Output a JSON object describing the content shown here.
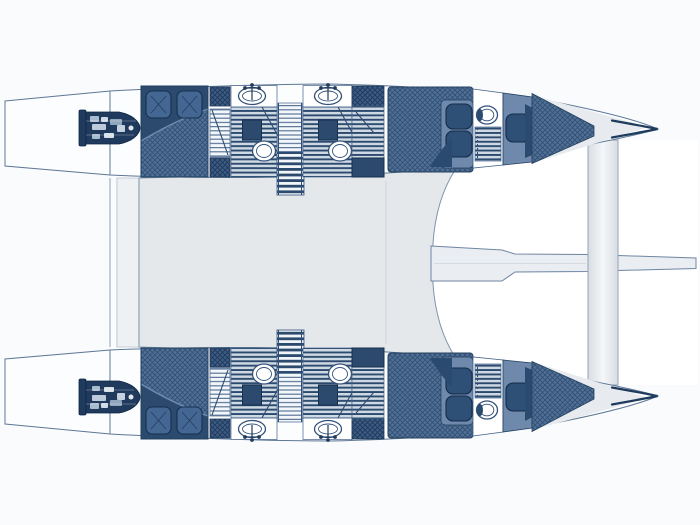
{
  "diagram": {
    "type": "floor-plan",
    "subject": "catamaran deck layout, top view",
    "orientation": "bow pointing right, twin hulls top and bottom",
    "features": {
      "hulls": 2,
      "engines": 2,
      "aft_double_cabins": 2,
      "forward_berths_per_hull": 2,
      "bathrooms_with_shower": 4,
      "bow_toilet_compartments": 2,
      "sinks": 4,
      "toilets": 6,
      "shower_seats": 4,
      "staircases_per_hull": 2,
      "bridgedeck_saloon": 1,
      "aft_cockpit_strip": 1,
      "forward_crossbeam": 1,
      "bowsprit": 1,
      "trampoline_area": 1
    }
  },
  "colors": {
    "page_background": "#fafbfc",
    "trampoline_white": "#ffffff",
    "bridgedeck_gray": "#e4e8eb",
    "cockpit_gray": "#eef1f4",
    "deck": "#e7eaee",
    "hull_white": "#fcfdff",
    "outline": "#5d7795",
    "navy": "#2b4a6e",
    "navy_dark": "#1f3a5c",
    "slate": "#4f7097",
    "slate_dark": "#3c5c84",
    "stripe_light": "#cfd9e4",
    "beam_stroke": "#93a3b8"
  }
}
